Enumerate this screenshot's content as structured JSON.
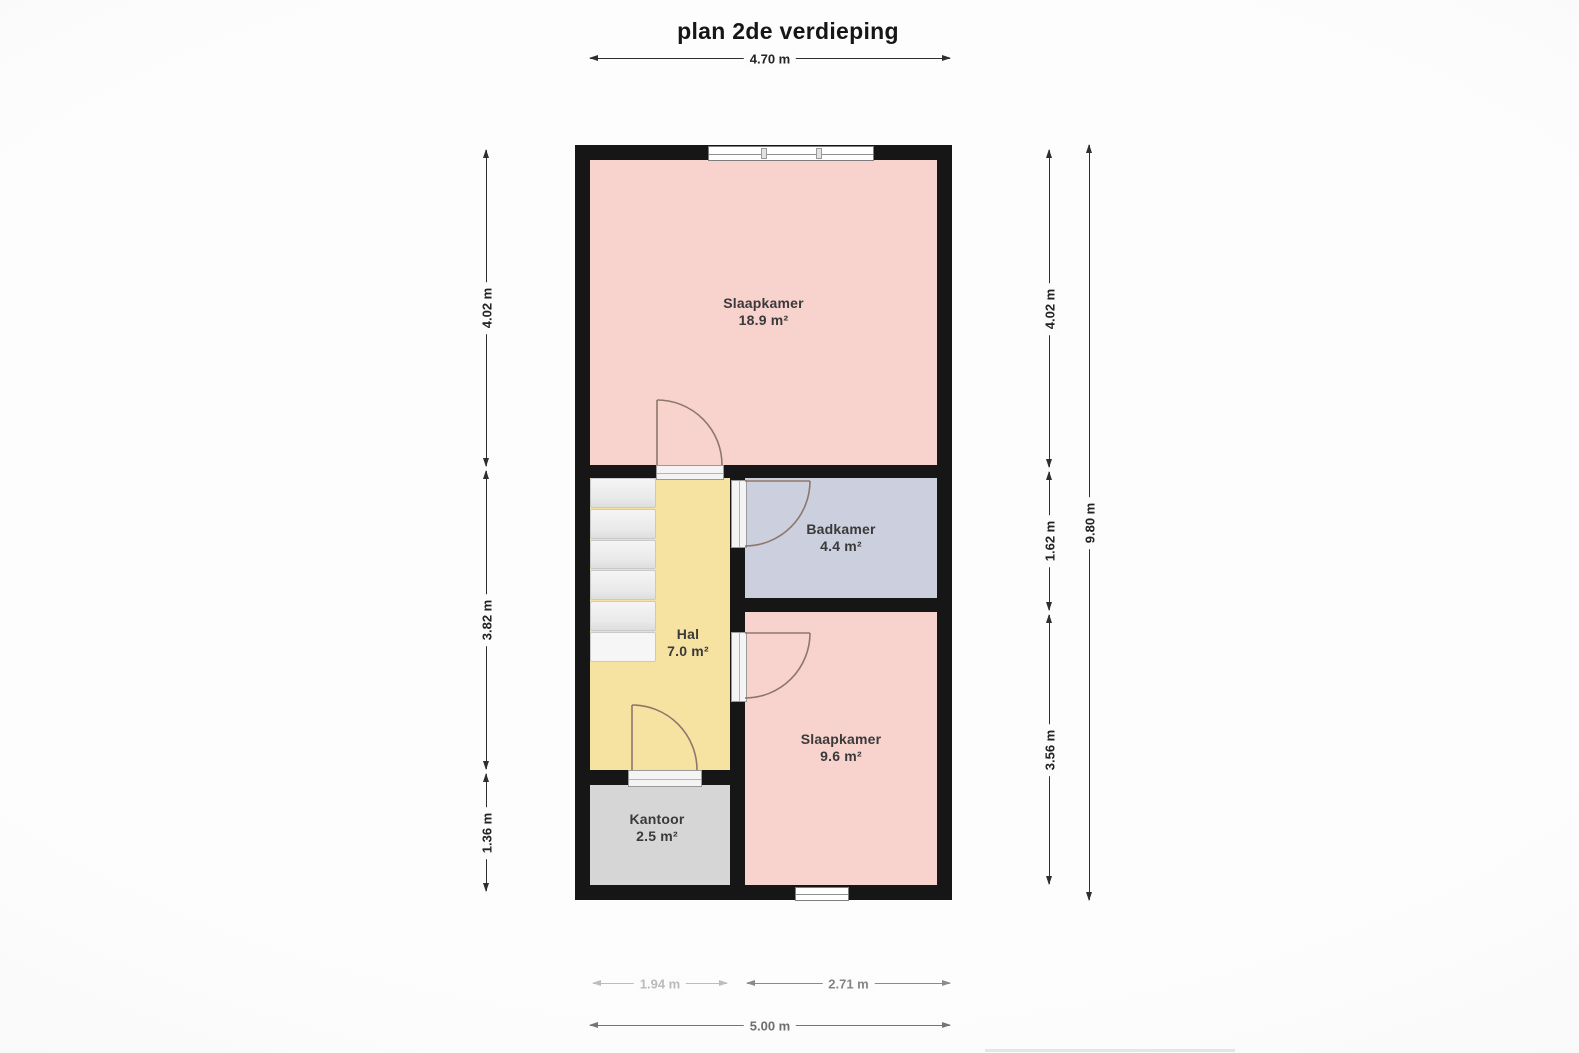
{
  "title": "plan 2de verdieping",
  "rooms": [
    {
      "name": "Slaapkamer",
      "area": "18.9 m²"
    },
    {
      "name": "Badkamer",
      "area": "4.4 m²"
    },
    {
      "name": "Hal",
      "area": "7.0 m²"
    },
    {
      "name": "Slaapkamer",
      "area": "9.6 m²"
    },
    {
      "name": "Kantoor",
      "area": "2.5 m²"
    }
  ],
  "dimensions": {
    "top_width": "4.70 m",
    "left": [
      "4.02 m",
      "3.82 m",
      "1.36 m"
    ],
    "right_inner": [
      "4.02 m",
      "1.62 m",
      "3.56 m"
    ],
    "right_total_height": "9.80 m",
    "bottom_left": "1.94 m",
    "bottom_right": "2.71 m",
    "bottom_total": "5.00 m"
  },
  "colors": {
    "wall": "#161616",
    "bedroom_fill": "#f8d2cd",
    "hall_fill": "#f7e3a1",
    "bathroom_fill": "#cccfde",
    "office_fill": "#d6d6d7",
    "stair_fill": "#ececec"
  }
}
